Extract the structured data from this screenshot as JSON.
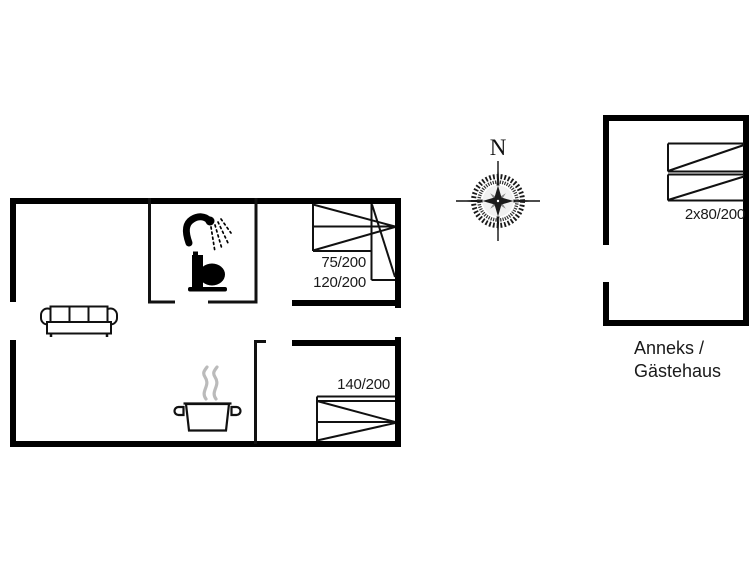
{
  "title": "Holiday house floor plan",
  "colors": {
    "wall": "#000000",
    "thin_line": "#1a1a1a",
    "steam": "#bbbbbb",
    "text": "#1a1a1a"
  },
  "compass": {
    "north_label": "N"
  },
  "main_house": {
    "rooms": [
      "living-room-kitchen",
      "bathroom",
      "bedroom-top",
      "bedroom-bottom"
    ],
    "bed_labels": {
      "bed_75": "75/200",
      "bed_120": "120/200",
      "bed_140": "140/200"
    }
  },
  "annex": {
    "bed_label": "2x80/200",
    "caption_line1": "Anneks /",
    "caption_line2": "Gästehaus"
  }
}
